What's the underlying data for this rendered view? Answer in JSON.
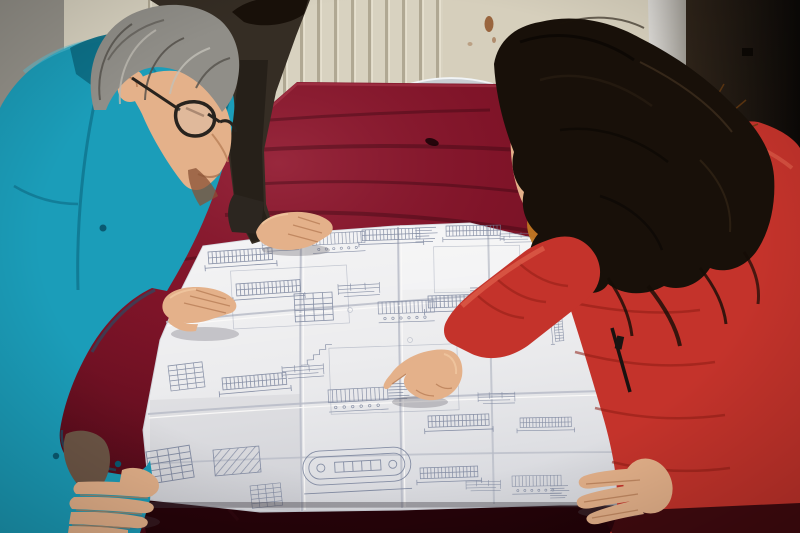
{
  "scene": {
    "type": "photograph",
    "description": "Two workers review a large folded engineering blueprint spread over a dark red velvet covered table. A gray-haired man in a teal work jacket and black glasses leans on the left edge; a woman in a red quilted down coat with an orange fur hood trim points at a detail with her right index finger; a third person in a dark jacket rests one hand on the far edge of the sheet."
  },
  "room": {
    "left_wall": "bare gray plaster corner",
    "back_wall": "cream panel radiator with vertical ribs",
    "right_side": "light door frame and dark brown door",
    "stain": "rust drip on wall above radiator"
  },
  "furniture": {
    "table": "large table draped in dark crimson crushed velvet",
    "chair": "chrome framed chair with red upholstered back behind the table"
  },
  "blueprint": {
    "description": "white construction drawing with dense rebar schedules, beam elevations, dimension lines, note tables and an oval tank outline",
    "folds": "creased into roughly 4 x 3 panels"
  },
  "people": [
    {
      "id": "worker-left",
      "description": "middle-aged man, gray hair, black rectangular glasses, teal work jacket, both hands on the drawing"
    },
    {
      "id": "colleague-behind",
      "description": "partially visible person in dark brown jacket, black hair, right hand resting on far edge of sheet"
    },
    {
      "id": "woman-right",
      "description": "woman with long dark wavy hair, red down coat with orange fur collar, pointing at the drawing"
    }
  ],
  "palette": {
    "wall_gray": "#95928a",
    "radiator_cream": "#d8d2c0",
    "radiator_rib": "#b0a893",
    "wall_cream": "#d6cfbc",
    "rust": "#8a4a1e",
    "door_panel": "#c7c4be",
    "door_dark": "#201812",
    "chair_chrome": "#c9ced3",
    "chair_red": "#b2242e",
    "velvet": "#7c1226",
    "paper": "#eaeaec",
    "ink": "#76809a",
    "teal": "#1b9db9",
    "teal_dark": "#0d6f86",
    "lining": "#6d5646",
    "dark_jacket": "#352d24",
    "hair_black": "#181009",
    "hair_gray": "#908e88",
    "skin": "#e4b18a",
    "skin_shadow": "#bf8157",
    "glasses": "#28231e",
    "coat_red": "#c4332b",
    "coat_deep": "#8c1d15",
    "fur": "#c07722",
    "fur_dark": "#663a0e",
    "zipper": "#191210"
  }
}
